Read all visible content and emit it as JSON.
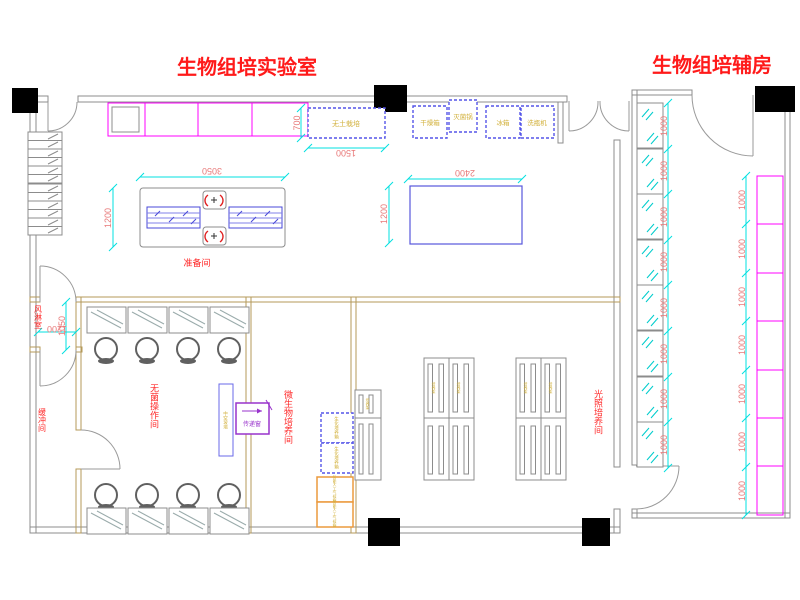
{
  "titles": {
    "main": "生物组培实验室",
    "aux": "生物组培辅房"
  },
  "rooms": {
    "prep": "准备间",
    "air_shower": "风淋室",
    "buffer": "缓冲间",
    "sterile_op": "无菌操作间",
    "micro_culture": "微生物培养间",
    "light_culture": "光照培养间"
  },
  "equipment": {
    "soilless": "无土栽培",
    "drying_oven": "干燥箱",
    "sterilizer": "灭菌锅",
    "fridge": "冰箱",
    "bottle_washer": "洗瓶机",
    "pass_window": "传递窗",
    "glass_partition": "中空玻璃",
    "bio_incubator": "生化培养箱",
    "climate_chamber": "智能人工气候箱",
    "culture_rack": "培养架"
  },
  "dims": {
    "prep_w": "3050",
    "prep_d": "1200",
    "table_w": "2400",
    "table_d": "1200",
    "soilless_d": "700",
    "soilless_w": "1500",
    "shower_d": "1050",
    "shower_w": "1200",
    "module": "1000"
  },
  "colors": {
    "title_red": "#ff1a1a",
    "label_red": "#ff2a2a",
    "dim_text": "#e87878",
    "dim_line_cyan": "#00e0e0",
    "counter_magenta": "#ff00ff",
    "interior_wall_tan": "#b49a5a",
    "equipment_yellow": "#d2b13c",
    "equipment_blue": "#5555e8",
    "climate_orange": "#eb9a3d",
    "pass_window_purple": "#9933cc"
  }
}
